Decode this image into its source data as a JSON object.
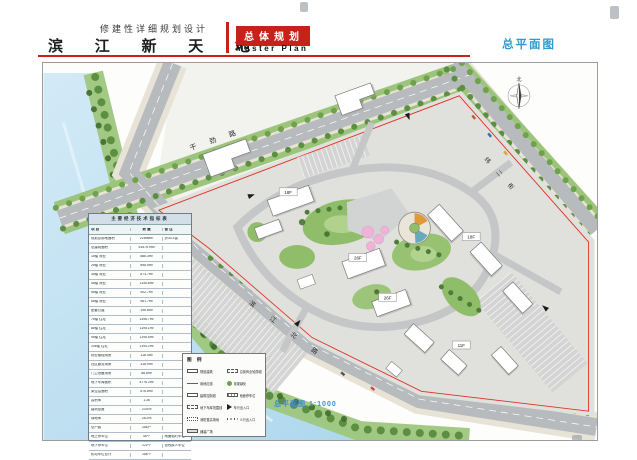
{
  "header": {
    "project_type": "修建性详细规划设计",
    "project_name": "滨 江 新 天 地",
    "badge": "总体规划",
    "badge_en": "Master Plan",
    "sheet_label": "总平面图"
  },
  "plan": {
    "road_top": "干 劲 路",
    "road_right": "纬 二 街",
    "road_bottom": "滨 江 北 路",
    "scale_label": "总平面图 1:1000",
    "compass_n": "北",
    "buildings": {
      "b1": "18F",
      "b2": "26F",
      "b3": "26F",
      "b4": "18F",
      "b5": "11F"
    }
  },
  "table": {
    "title": "主要经济技术指标表",
    "headers": [
      "项 目",
      "数 量",
      "备 注"
    ],
    "rows": [
      {
        "name": "规划总用地面积",
        "value": "22896m²",
        "note": "折34.3亩"
      },
      {
        "name": "总建筑面积",
        "value": "51575.9m²",
        "note": ""
      },
      {
        "name": "1#楼 商业",
        "value": "888.3m²",
        "note": ""
      },
      {
        "name": "2#楼 商业",
        "value": "898.5m²",
        "note": ""
      },
      {
        "name": "3#楼 商业",
        "value": "873.7m²",
        "note": ""
      },
      {
        "name": "4#楼 商业",
        "value": "1145.8m²",
        "note": ""
      },
      {
        "name": "5#楼 商业",
        "value": "902.7m²",
        "note": ""
      },
      {
        "name": "6#楼 商业",
        "value": "961.7m²",
        "note": ""
      },
      {
        "name": "配套公建",
        "value": "196.8m²",
        "note": ""
      },
      {
        "name": "7#楼 住宅",
        "value": "1196.7m²",
        "note": ""
      },
      {
        "name": "8#楼 住宅",
        "value": "1195.1m²",
        "note": ""
      },
      {
        "name": "9#楼 住宅",
        "value": "1195.5m²",
        "note": ""
      },
      {
        "name": "10#楼 住宅",
        "value": "1194.2m²",
        "note": ""
      },
      {
        "name": "物业管理用房",
        "value": "118.4m²",
        "note": ""
      },
      {
        "name": "社区服务用房",
        "value": "318.9m²",
        "note": ""
      },
      {
        "name": "门卫设备用房",
        "value": "86.8m²",
        "note": ""
      },
      {
        "name": "地下车库面积",
        "value": "4776.2m²",
        "note": ""
      },
      {
        "name": "架空层面积",
        "value": "676.8m²",
        "note": ""
      },
      {
        "name": "容积率",
        "value": "1.36",
        "note": ""
      },
      {
        "name": "建筑密度",
        "value": "23.6%",
        "note": ""
      },
      {
        "name": "绿地率",
        "value": "28.3%",
        "note": ""
      },
      {
        "name": "总户数",
        "value": "266户",
        "note": ""
      },
      {
        "name": "地上停车位",
        "value": "46个",
        "note": "地面临时车位"
      },
      {
        "name": "地下停车位",
        "value": "220个",
        "note": "含残疾人车位"
      },
      {
        "name": "机动车位合计",
        "value": "266个",
        "note": ""
      },
      {
        "name": "非机动车位",
        "value": "202个",
        "note": ""
      }
    ]
  },
  "legend": {
    "title": "图 例",
    "left": [
      {
        "sym": "plain",
        "label": "规划建筑"
      },
      {
        "sym": "line",
        "label": "用地红线"
      },
      {
        "sym": "bold",
        "label": "建筑控制线"
      },
      {
        "sym": "dash",
        "label": "地下车库范围线"
      },
      {
        "sym": "dot",
        "label": "消防登高场地"
      },
      {
        "sym": "fill",
        "label": "铺装广场"
      }
    ],
    "right": [
      {
        "sym": "dash",
        "label": "沿街商业轮廓线"
      },
      {
        "sym": "tree",
        "label": "景观绿化"
      },
      {
        "sym": "hatch",
        "label": "地面停车位"
      },
      {
        "sym": "arrow",
        "label": "车行出入口"
      },
      {
        "sym": "dots",
        "label": "人行出入口"
      }
    ]
  },
  "colors": {
    "accent_red": "#c8201a",
    "sheet_blue": "#2e9ace",
    "boundary_red": "#e03026",
    "water": "#bfe0f1",
    "road": "#b8bbbd",
    "green": "#7fae5e"
  }
}
